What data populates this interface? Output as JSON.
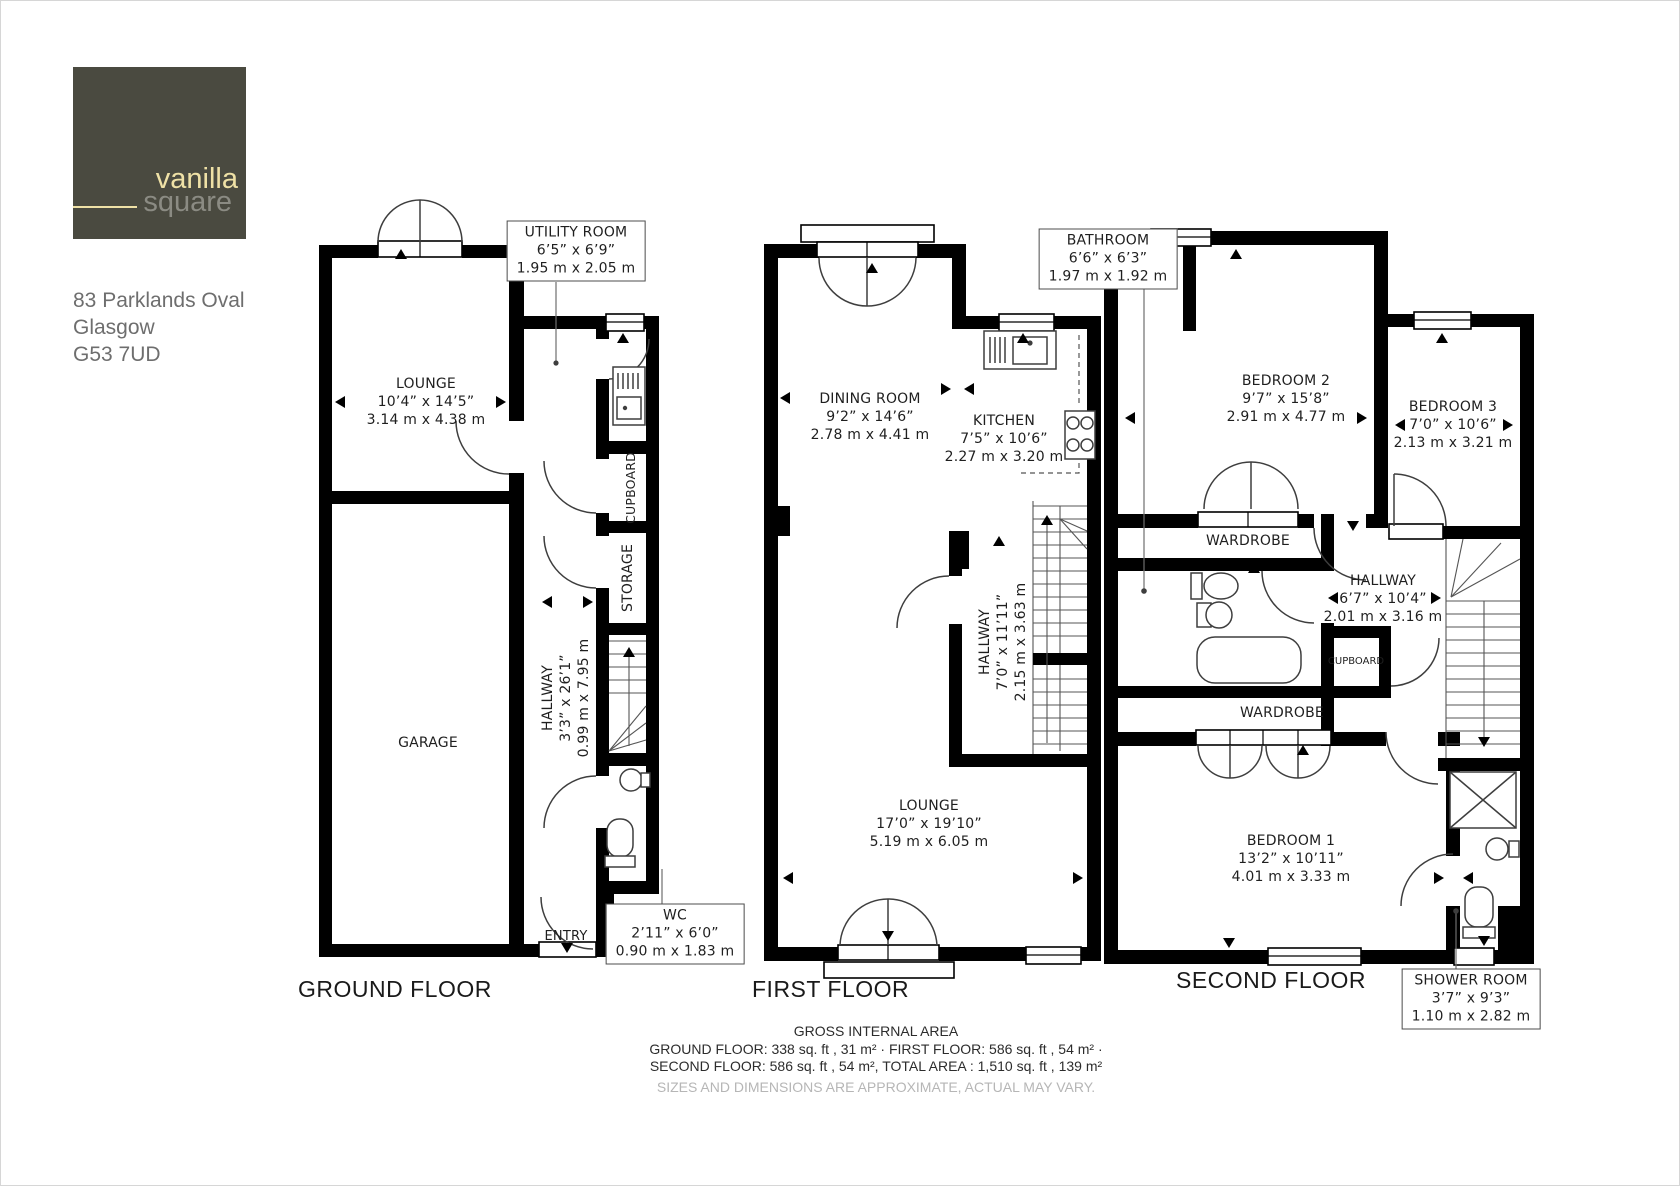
{
  "branding": {
    "name_top": "vanilla",
    "name_bottom": "square",
    "logo_bg": "#4a4a40",
    "top_color": "#efe1a6",
    "bottom_color": "#8b8b83"
  },
  "address": {
    "line1": "83 Parklands Oval",
    "line2": "Glasgow",
    "line3": "G53 7UD"
  },
  "colors": {
    "wall": "#000000",
    "label_text": "#1f1f1f",
    "note_grey": "#b6b6b6"
  },
  "floors": {
    "ground": {
      "title": "GROUND FLOOR",
      "rooms": {
        "lounge": {
          "name": "LOUNGE",
          "imperial": "10’4” x 14’5”",
          "metric": "3.14 m x 4.38 m"
        },
        "utility": {
          "name": "UTILITY ROOM",
          "imperial": "6’5” x 6’9”",
          "metric": "1.95 m x 2.05 m"
        },
        "cupboard": {
          "name": "CUPBOARD"
        },
        "storage": {
          "name": "STORAGE"
        },
        "hallway": {
          "name": "HALLWAY",
          "imperial": "3’3” x 26’1”",
          "metric": "0.99 m x 7.95 m"
        },
        "garage": {
          "name": "GARAGE"
        },
        "wc": {
          "name": "WC",
          "imperial": "2’11” x 6’0”",
          "metric": "0.90 m x 1.83 m"
        },
        "entry": {
          "name": "ENTRY"
        }
      }
    },
    "first": {
      "title": "FIRST FLOOR",
      "rooms": {
        "dining": {
          "name": "DINING ROOM",
          "imperial": "9’2” x 14’6”",
          "metric": "2.78 m x 4.41 m"
        },
        "kitchen": {
          "name": "KITCHEN",
          "imperial": "7’5” x 10’6”",
          "metric": "2.27 m x 3.20 m"
        },
        "hallway": {
          "name": "HALLWAY",
          "imperial": "7’0” x 11’11”",
          "metric": "2.15 m x 3.63 m"
        },
        "lounge": {
          "name": "LOUNGE",
          "imperial": "17’0” x 19’10”",
          "metric": "5.19 m x 6.05 m"
        }
      }
    },
    "second": {
      "title": "SECOND FLOOR",
      "rooms": {
        "bathroom": {
          "name": "BATHROOM",
          "imperial": "6’6” x 6’3”",
          "metric": "1.97 m x 1.92 m"
        },
        "bedroom2": {
          "name": "BEDROOM 2",
          "imperial": "9’7” x 15’8”",
          "metric": "2.91 m x 4.77 m"
        },
        "bedroom3": {
          "name": "BEDROOM 3",
          "imperial": "7’0” x 10’6”",
          "metric": "2.13 m x 3.21 m"
        },
        "wardrobe_a": {
          "name": "WARDROBE"
        },
        "hallway": {
          "name": "HALLWAY",
          "imperial": "6’7” x 10’4”",
          "metric": "2.01 m x 3.16 m"
        },
        "cupboard": {
          "name": "CUPBOARD"
        },
        "wardrobe_b": {
          "name": "WARDROBE"
        },
        "bedroom1": {
          "name": "BEDROOM 1",
          "imperial": "13’2” x 10’11”",
          "metric": "4.01 m x 3.33 m"
        },
        "shower": {
          "name": "SHOWER ROOM",
          "imperial": "3’7” x 9’3”",
          "metric": "1.10 m x 2.82 m"
        }
      }
    }
  },
  "footer": {
    "heading": "GROSS INTERNAL AREA",
    "line1": "GROUND FLOOR: 338 sq. ft , 31 m² · FIRST FLOOR: 586 sq. ft , 54 m² ·",
    "line2": "SECOND FLOOR: 586 sq. ft , 54 m², TOTAL AREA : 1,510 sq. ft , 139 m²",
    "disclaimer": "SIZES AND DIMENSIONS ARE APPROXIMATE, ACTUAL MAY VARY."
  }
}
